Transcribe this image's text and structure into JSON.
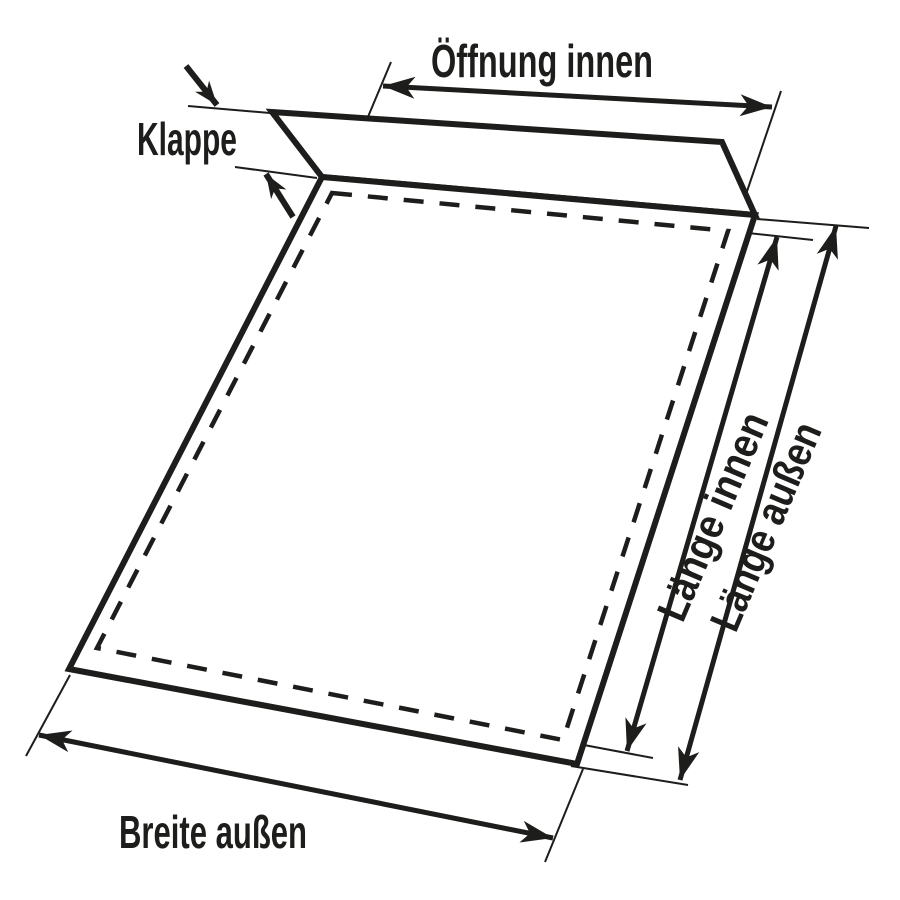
{
  "diagram": {
    "labels": {
      "opening_inner": "Öffnung innen",
      "flap": "Klappe",
      "length_inner": "Länge innen",
      "length_outer": "Länge außen",
      "width_outer": "Breite außen"
    },
    "colors": {
      "line": "#1d1d1b",
      "background": "#ffffff"
    }
  }
}
